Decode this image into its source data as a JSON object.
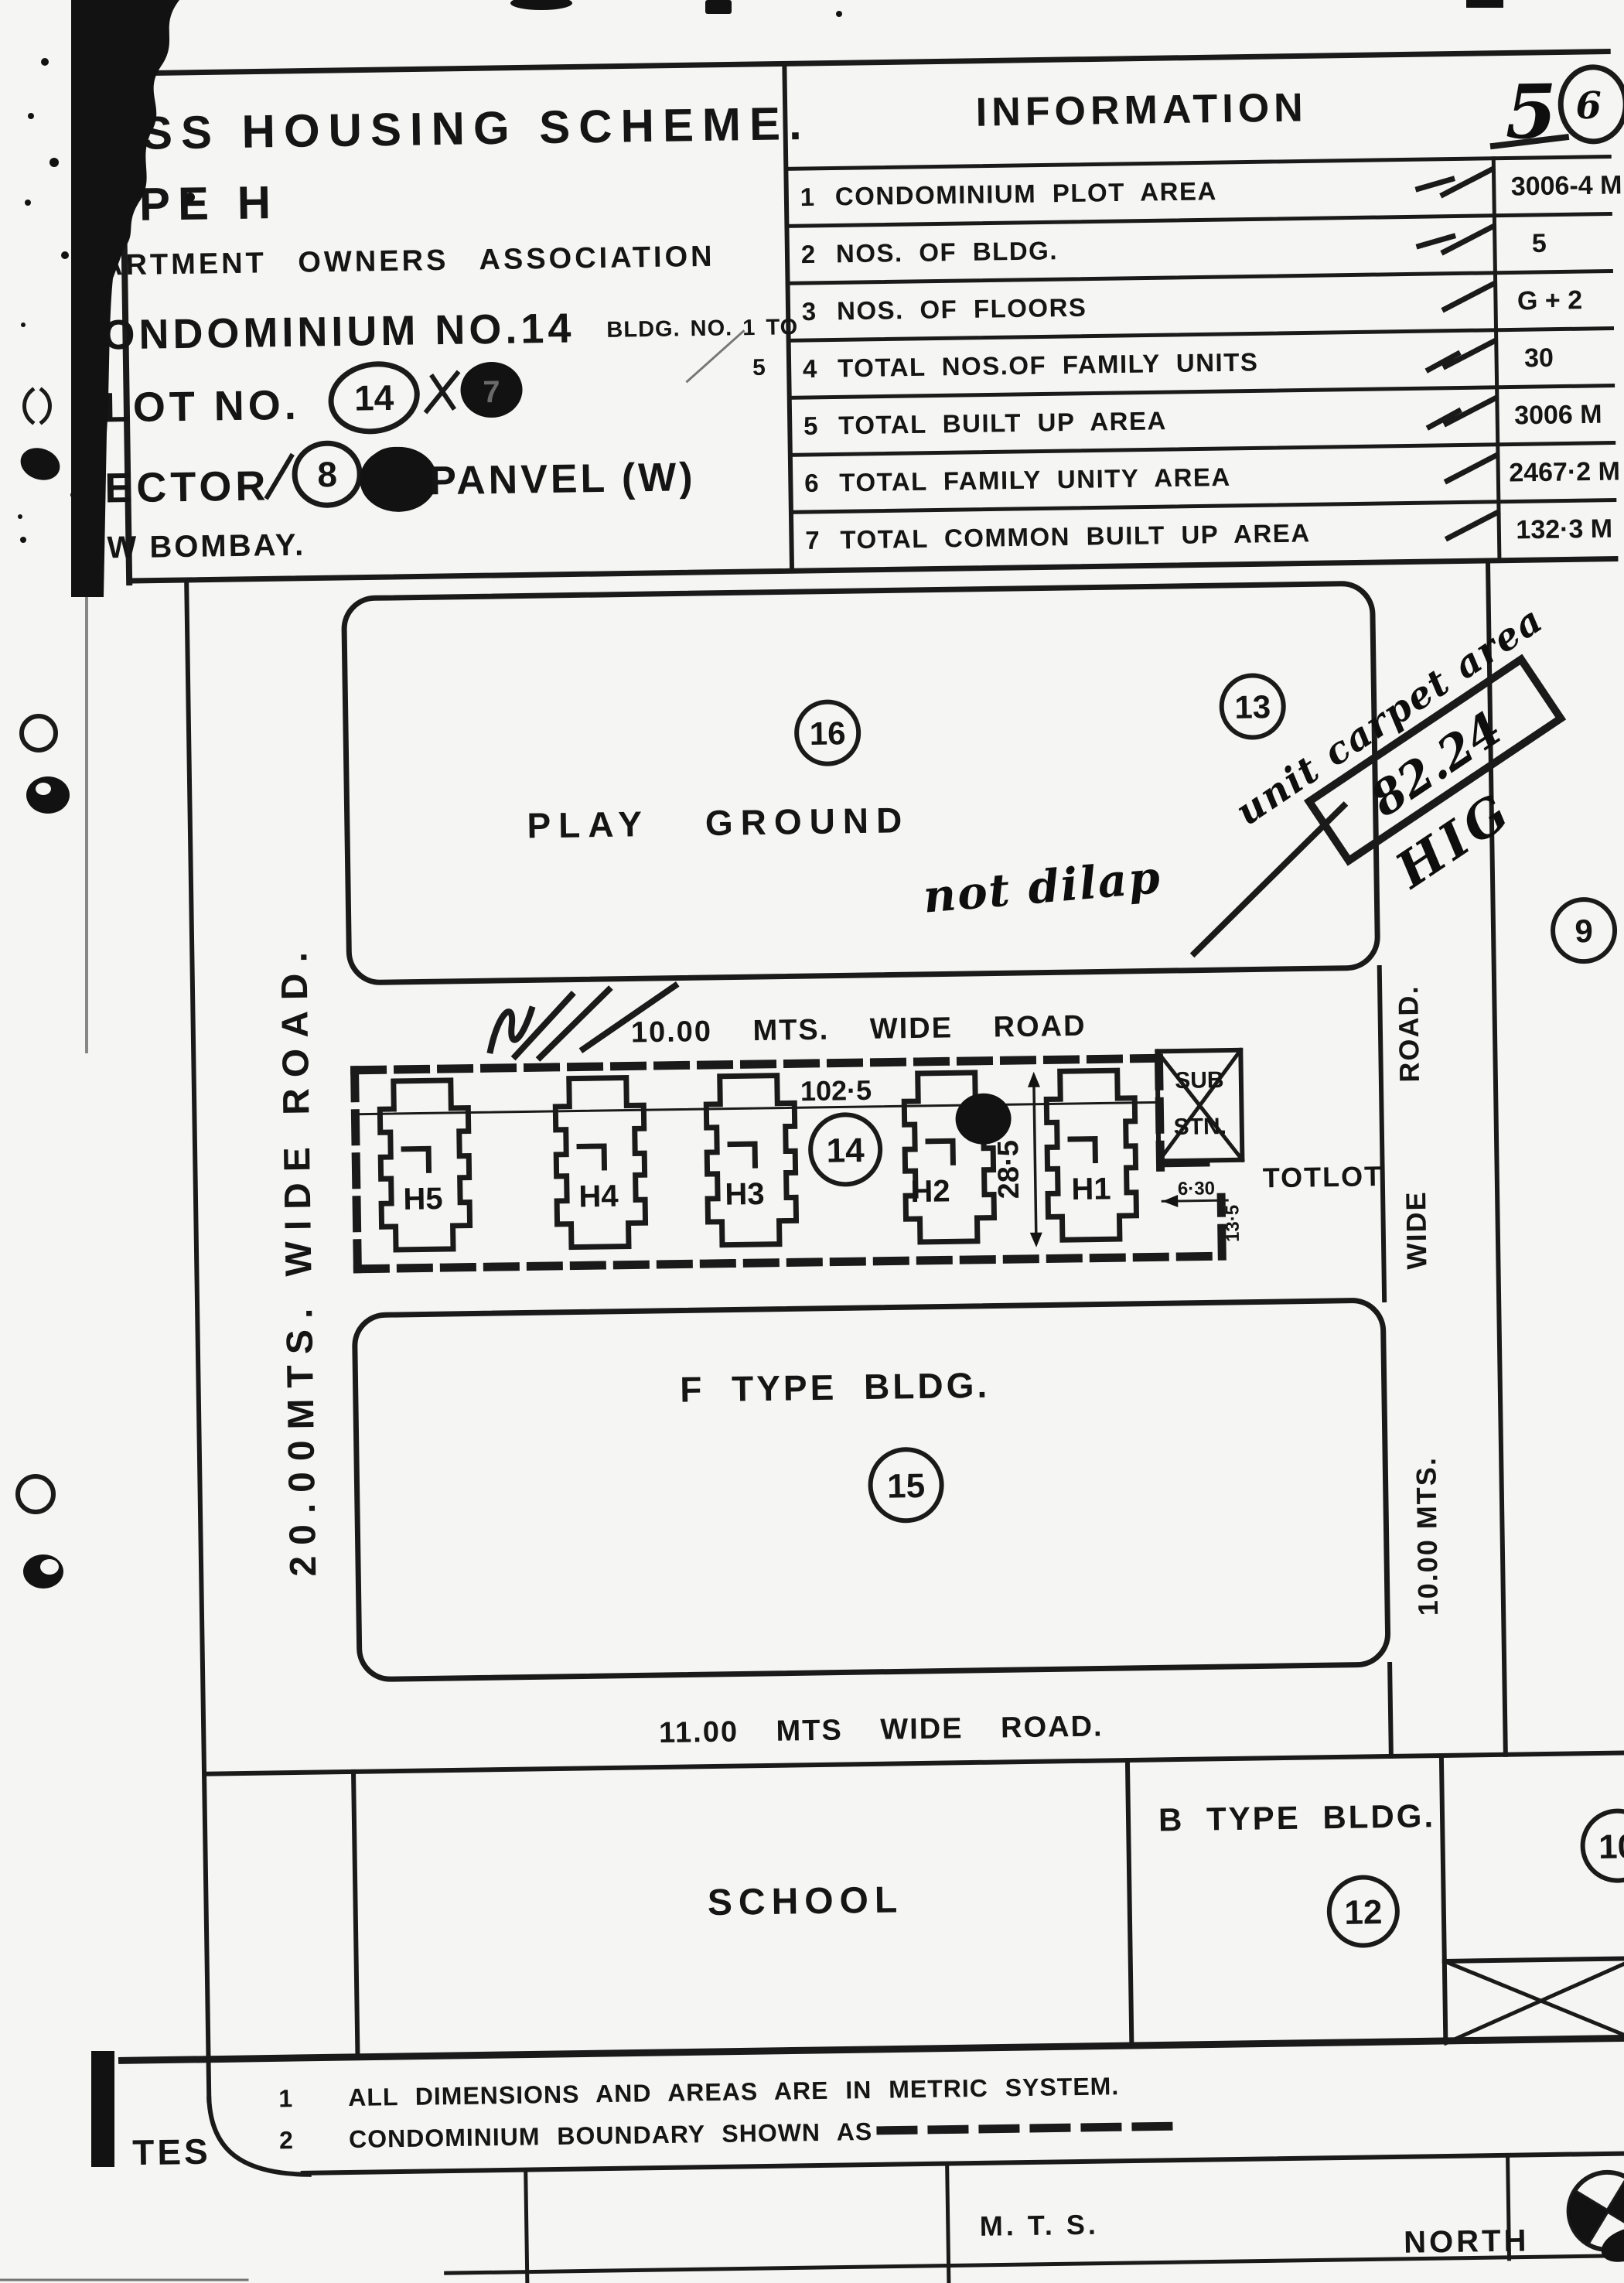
{
  "colors": {
    "ink": "#1a1a1a",
    "paper": "#f5f5f3"
  },
  "title_block": {
    "scheme_line": "ASS HOUSING SCHEME.",
    "type_line": "YPE H",
    "association_line": "ARTMENT OWNERS ASSOCIATION",
    "condominium_line": "ONDOMINIUM NO.14",
    "bldg_line": "BLDG. NO. 1 TO",
    "bldg_line_end": "5",
    "plot_label": "LOT NO.",
    "plot_no": "14",
    "plot_no_alt": "7",
    "sector_label": "ECTOR",
    "sector_no": "8",
    "sector_place": "PANVEL (W)",
    "city_line": "W BOMBAY."
  },
  "information_table": {
    "title": "INFORMATION",
    "handwritten_sheet_no": "5",
    "handwritten_circle_no": "6",
    "rows": [
      {
        "no": "1",
        "label": "CONDOMINIUM PLOT AREA",
        "value": "3006-4 M"
      },
      {
        "no": "2",
        "label": "NOS. OF BLDG.",
        "value": "5"
      },
      {
        "no": "3",
        "label": "NOS. OF FLOORS",
        "value": "G + 2"
      },
      {
        "no": "4",
        "label": "TOTAL NOS.OF FAMILY UNITS",
        "value": "30"
      },
      {
        "no": "5",
        "label": "TOTAL BUILT UP AREA",
        "value": "3006 M"
      },
      {
        "no": "6",
        "label": "TOTAL FAMILY UNITY AREA",
        "value": "2467·2 M"
      },
      {
        "no": "7",
        "label": "TOTAL COMMON BUILT UP AREA",
        "value": "132·3 M"
      }
    ]
  },
  "plan": {
    "playground_label": "PLAY GROUND",
    "playground_no": "16",
    "plot_13": "13",
    "plot_9": "9",
    "plot_10": "10",
    "road_top": "10.00 MTS. WIDE ROAD",
    "road_left": "20.00MTS. WIDE ROAD.",
    "road_right_name": "ROAD.",
    "road_right_wide": "WIDE",
    "road_right_mts": "10.00 MTS.",
    "road_bottom": "11.00 MTS WIDE ROAD.",
    "condo": {
      "no": "14",
      "buildings": [
        "H5",
        "H4",
        "H3",
        "H2",
        "H1"
      ],
      "width_dim": "102·5",
      "depth_dim": "28·5",
      "sub_dim": "6·30",
      "tot_dim": "13·5",
      "substation_line1": "SUB",
      "substation_line2": "STN.",
      "totlot": "TOTLOT"
    },
    "f_type_label": "F TYPE BLDG.",
    "f_type_no": "15",
    "school_label": "SCHOOL",
    "b_type_label": "B TYPE BLDG.",
    "b_type_no": "12",
    "handwriting": {
      "carpet_note": "unit carpet area",
      "carpet_value": "82.24",
      "carpet_class": "HIG",
      "dilap_note": "not dilap"
    }
  },
  "notes": {
    "heading": "TES",
    "note1_no": "1",
    "note1": "ALL DIMENSIONS AND AREAS ARE IN METRIC SYSTEM.",
    "note2_no": "2",
    "note2": "CONDOMINIUM BOUNDARY SHOWN AS",
    "scale_label": "M. T. S.",
    "north_label": "NORTH"
  }
}
